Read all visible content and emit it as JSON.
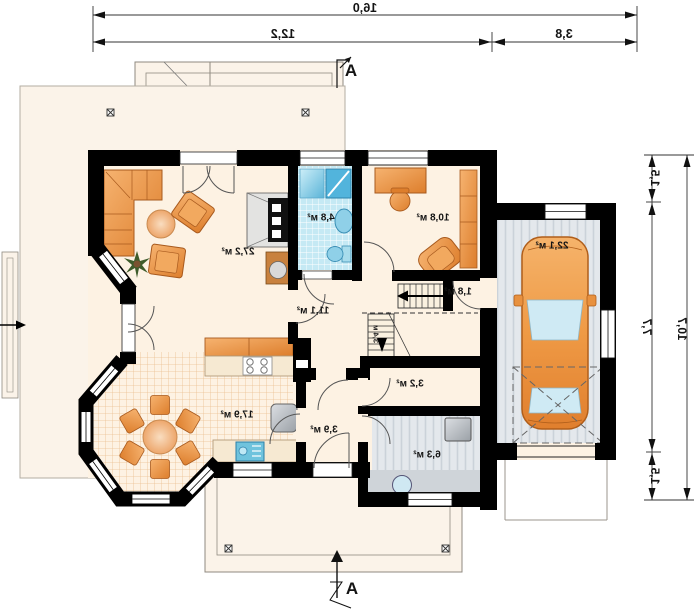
{
  "plan": {
    "title": "house-ground-floor-plan-mirrored",
    "section_marker": "A",
    "rooms": [
      {
        "id": "living-room",
        "area": "27,2 м²"
      },
      {
        "id": "bathroom",
        "area": "4,8 м²"
      },
      {
        "id": "office",
        "area": "10,8 м²"
      },
      {
        "id": "hall",
        "area": "11,1 м²"
      },
      {
        "id": "pantry",
        "area": "1,8 м²"
      },
      {
        "id": "kitchen-dining",
        "area": "17,9 м²"
      },
      {
        "id": "vestibule",
        "area": "3,9 м²"
      },
      {
        "id": "wc",
        "area": "3,2 м²"
      },
      {
        "id": "utility-room",
        "area": "6,3 м²"
      },
      {
        "id": "garage",
        "area": "22,1 м²"
      }
    ],
    "stair_label": "3,4 м",
    "dimensions": {
      "top_total": "16,0",
      "top_left": "12,2",
      "top_right": "3,8",
      "right_top": "1,5",
      "right_middle": "7,7",
      "right_bottom": "1,5",
      "right_total": "10,7"
    },
    "colors": {
      "wall": "#000000",
      "floor": "#fdf2e3",
      "terrace": "#fbf3e9",
      "tile_blue": "#c5e9f4",
      "garage_floor": "#e4e8ec",
      "furniture_orange": "#e8913f",
      "glass_blue": "#cfeaf4"
    }
  }
}
